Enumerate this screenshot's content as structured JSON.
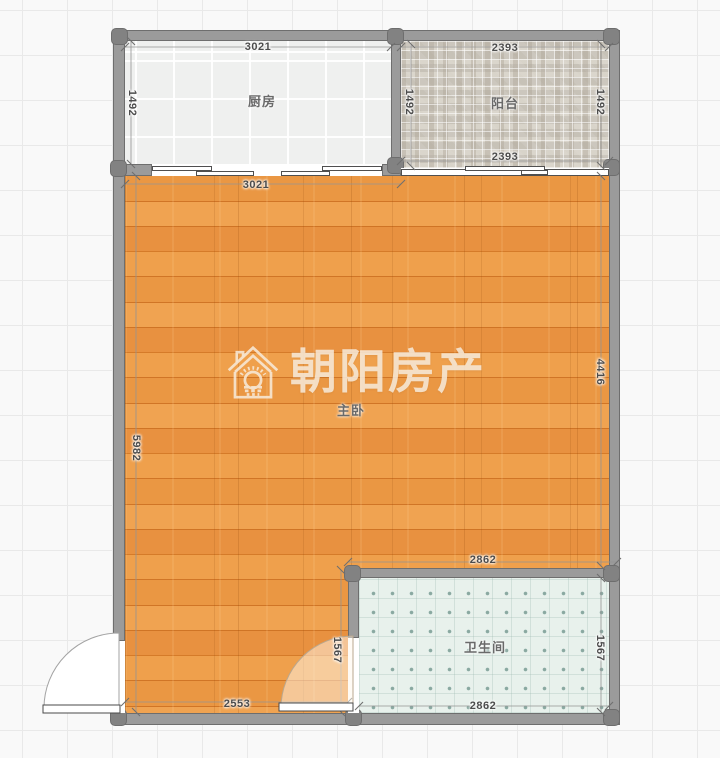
{
  "watermark": {
    "brand": "朝阳房产",
    "icon": "house-sun-icon"
  },
  "rooms": {
    "kitchen": {
      "name": "厨房",
      "dims": {
        "top": "3021",
        "left": "1492"
      }
    },
    "balcony": {
      "name": "阳台",
      "dims": {
        "top": "2393",
        "left": "1492",
        "right": "1492",
        "bottom": "2393"
      }
    },
    "bedroom": {
      "name": "主卧",
      "dims": {
        "top": "3021",
        "left": "5982",
        "right": "4416",
        "bottom": "2553"
      }
    },
    "bathroom": {
      "name": "卫生间",
      "dims": {
        "top": "2862",
        "left": "1567",
        "right": "1567",
        "bottom": "2862"
      }
    }
  },
  "colors": {
    "wood_floor": "#e6903a",
    "wall": "#9b9b9b",
    "balcony_tile": "#ccc7be",
    "kitchen_tile": "#eff0ef",
    "bathroom_floor": "#e8f1ec",
    "bathroom_dot": "#8aa9a1",
    "watermark_cream": "#f6ecd9",
    "dimension_text": "#4c4c4c",
    "room_label": "#6a6a6a"
  }
}
